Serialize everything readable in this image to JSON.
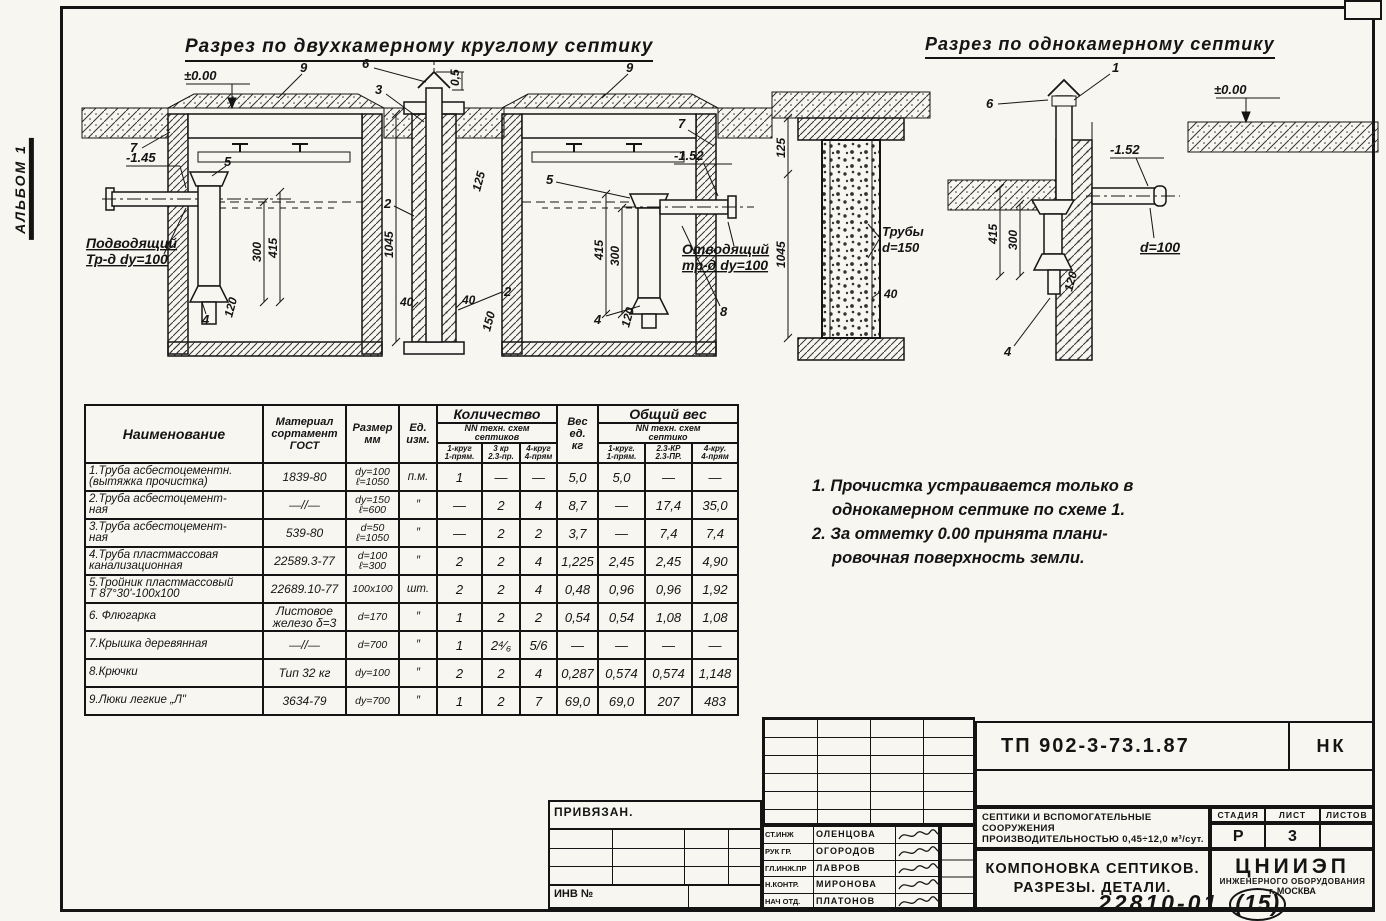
{
  "page": {
    "album": "АЛЬБОМ 1",
    "doc_number": "22810-01",
    "doc_sheet": "(15)"
  },
  "sections": {
    "two_chamber": {
      "title": "Разрез по двухкамерному круглому септику",
      "a": {
        "zero": "±0.00",
        "c9l": "9",
        "c6": "6",
        "c3": "3",
        "d05": "0,5",
        "c9r": "9",
        "c7l": "7",
        "c7r": "7",
        "inlet_level": "-1.45",
        "outlet_level": "-1.52",
        "c5l": "5",
        "c5r": "5",
        "c2t": "2",
        "c2b": "2",
        "c4l": "4",
        "c4r": "4",
        "c8": "8",
        "inlet_l1": "Подводящий",
        "inlet_l2": "Тр-д dy=100",
        "outlet_l1": "Отводящий",
        "outlet_l2": "тр-д dy=100",
        "d300l": "300",
        "d415l": "415",
        "d120l": "120",
        "d300r": "300",
        "d415r": "415",
        "d120r": "120",
        "d1045": "1045",
        "d40a": "40",
        "d40b": "40",
        "d150": "150",
        "d125": "125"
      }
    },
    "detail": {
      "a": {
        "d125": "125",
        "d1045": "1045",
        "tube_l1": "Трубы",
        "tube_l2": "d=150",
        "d40": "40"
      }
    },
    "one_chamber": {
      "title": "Разрез по однокамерному септику",
      "a": {
        "c1": "1",
        "c6": "6",
        "zero": "±0.00",
        "level": "-1.52",
        "d100": "d=100",
        "d415": "415",
        "d300": "300",
        "d120": "120",
        "c4": "4"
      }
    }
  },
  "table": {
    "header": {
      "name": "Наименование",
      "material_l1": "Материал",
      "material_l2": "сортамент",
      "material_l3": "ГОСТ",
      "size_l1": "Размер",
      "size_l2": "мм",
      "unit_l1": "Ед.",
      "unit_l2": "изм.",
      "qty": "Количество",
      "qty_sub_l1": "NN техн. схем",
      "qty_sub_l2": "септиков",
      "qty_c1_l1": "1-круг",
      "qty_c1_l2": "1-прям.",
      "qty_c2_l1": "3 кр",
      "qty_c2_l2": "2.3-пр.",
      "qty_c3_l1": "4-круг",
      "qty_c3_l2": "4-прям",
      "weight_l1": "Вес",
      "weight_l2": "ед.",
      "weight_l3": "кг",
      "total": "Общий вес",
      "total_sub_l1": "NN техн. схем",
      "total_sub_l2": "септико",
      "total_c1_l1": "1-круг.",
      "total_c1_l2": "1-прям.",
      "total_c2_l1": "2.3-КР",
      "total_c2_l2": "2.3-ПР.",
      "total_c3_l1": "4-кру.",
      "total_c3_l2": "4-прям"
    },
    "rows": [
      {
        "name_l1": "1.Труба асбестоцементн.",
        "name_l2": "(вытяжка прочистка)",
        "gost_l1": "1839-80",
        "gost_l2": "",
        "size_l1": "dy=100",
        "size_l2": "ℓ=1050",
        "unit": "п.м.",
        "q1": "1",
        "q2": "—",
        "q3": "—",
        "w": "5,0",
        "t1": "5,0",
        "t2": "—",
        "t3": "—"
      },
      {
        "name_l1": "2.Труба асбестоцемент-",
        "name_l2": "ная",
        "gost_l1": "—//—",
        "gost_l2": "",
        "size_l1": "dy=150",
        "size_l2": "ℓ=600",
        "unit": "″",
        "q1": "—",
        "q2": "2",
        "q3": "4",
        "w": "8,7",
        "t1": "—",
        "t2": "17,4",
        "t3": "35,0"
      },
      {
        "name_l1": "3.Труба асбестоцемент-",
        "name_l2": "ная",
        "gost_l1": "539-80",
        "gost_l2": "",
        "size_l1": "d=50",
        "size_l2": "ℓ=1050",
        "unit": "″",
        "q1": "—",
        "q2": "2",
        "q3": "2",
        "w": "3,7",
        "t1": "—",
        "t2": "7,4",
        "t3": "7,4"
      },
      {
        "name_l1": "4.Труба пластмассовая",
        "name_l2": "канализационная",
        "gost_l1": "22589.3-77",
        "gost_l2": "",
        "size_l1": "d=100",
        "size_l2": "ℓ=300",
        "unit": "″",
        "q1": "2",
        "q2": "2",
        "q3": "4",
        "w": "1,225",
        "t1": "2,45",
        "t2": "2,45",
        "t3": "4,90"
      },
      {
        "name_l1": "5.Тройник пластмассовый",
        "name_l2": "Т 87°30'-100х100",
        "gost_l1": "22689.10-77",
        "gost_l2": "",
        "size_l1": "100х100",
        "size_l2": "",
        "unit": "шт.",
        "q1": "2",
        "q2": "2",
        "q3": "4",
        "w": "0,48",
        "t1": "0,96",
        "t2": "0,96",
        "t3": "1,92"
      },
      {
        "name_l1": "6. Флюгарка",
        "name_l2": "",
        "gost_l1": "Листовое",
        "gost_l2": "железо δ=3",
        "size_l1": "d=170",
        "size_l2": "",
        "unit": "″",
        "q1": "1",
        "q2": "2",
        "q3": "2",
        "w": "0,54",
        "t1": "0,54",
        "t2": "1,08",
        "t3": "1,08"
      },
      {
        "name_l1": "7.Крышка деревянная",
        "name_l2": "",
        "gost_l1": "—//—",
        "gost_l2": "",
        "size_l1": "d=700",
        "size_l2": "",
        "unit": "″",
        "q1": "1",
        "q2": "2⁴⁄₆",
        "q3": "5/6",
        "w": "—",
        "t1": "—",
        "t2": "—",
        "t3": "—"
      },
      {
        "name_l1": "8.Крючки",
        "name_l2": "",
        "gost_l1": "Тип 32 кг",
        "gost_l2": "",
        "size_l1": "dy=100",
        "size_l2": "",
        "unit": "″",
        "q1": "2",
        "q2": "2",
        "q3": "4",
        "w": "0,287",
        "t1": "0,574",
        "t2": "0,574",
        "t3": "1,148"
      },
      {
        "name_l1": "9.Люки легкие „Л\"",
        "name_l2": "",
        "gost_l1": "3634-79",
        "gost_l2": "",
        "size_l1": "dy=700",
        "size_l2": "",
        "unit": "″",
        "q1": "1",
        "q2": "2",
        "q3": "7",
        "w": "69,0",
        "t1": "69,0",
        "t2": "207",
        "t3": "483"
      }
    ]
  },
  "notes": {
    "n1_l1": "1. Прочистка устраивается только в",
    "n1_l2": "однокамерном септике по схеме 1.",
    "n2_l1": "2. За отметку 0.00 принята плани-",
    "n2_l2": "ровочная поверхность земли."
  },
  "title_block": {
    "doc_code": "ТП 902-3-73.1.87",
    "mark": "НК",
    "privyazan": "ПРИВЯЗАН.",
    "inv": "ИНВ №",
    "roles": [
      {
        "role": "СТ.ИНЖ",
        "name": "ОЛЕНЦОВА"
      },
      {
        "role": "РУК ГР.",
        "name": "ОГОРОДОВ"
      },
      {
        "role": "ГЛ.ИНЖ.ПР",
        "name": "ЛАВРОВ"
      },
      {
        "role": "Н.КОНТР.",
        "name": "МИРОНОВА"
      },
      {
        "role": "НАЧ ОТД.",
        "name": "ПЛАТОНОВ"
      }
    ],
    "descr_l1": "СЕПТИКИ И ВСПОМОГАТЕЛЬНЫЕ",
    "descr_l2": "СООРУЖЕНИЯ",
    "descr_l3": "ПРОИЗВОДИТЕЛЬНОСТЬЮ 0,45÷12,0 м³/сут.",
    "sheet_title_l1": "КОМПОНОВКА СЕПТИКОВ.",
    "sheet_title_l2": "РАЗРЕЗЫ.  ДЕТАЛИ.",
    "stage_headers": [
      "СТАДИЯ",
      "ЛИСТ",
      "ЛИСТОВ"
    ],
    "stage": "Р",
    "sheet": "3",
    "sheets": "",
    "org_l1": "ЦНИИЭП",
    "org_l2": "ИНЖЕНЕРНОГО ОБОРУДОВАНИЯ",
    "org_l3": "г. МОСКВА"
  }
}
